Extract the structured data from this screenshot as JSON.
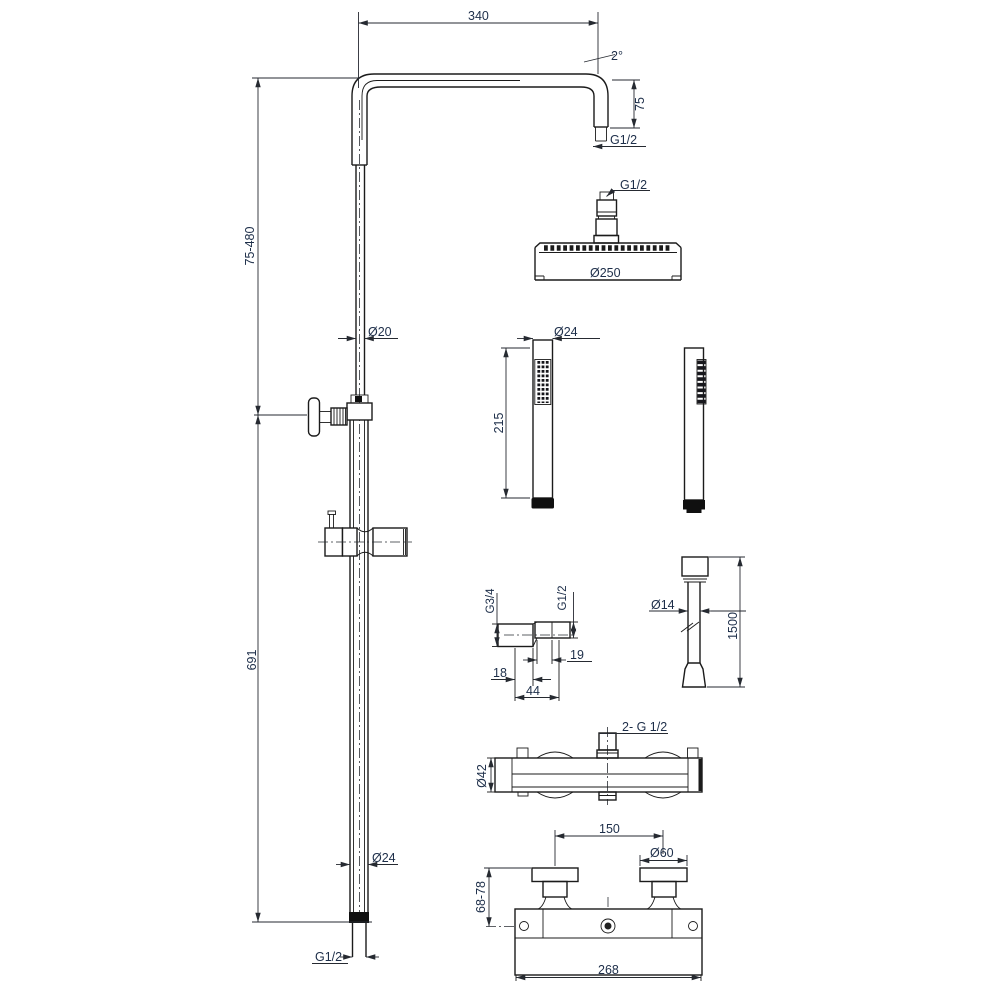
{
  "drawing": {
    "background": "#ffffff",
    "line_color": "#1b1b1b",
    "dim_color": "#1d2e49",
    "labels": {
      "arm_length": "340",
      "arm_angle": "2°",
      "arm_drop": "75",
      "arm_thread": "G1/2",
      "head_thread": "G1/2",
      "head_dia": "Ø250",
      "riser_upper_range": "75-480",
      "riser_upper_dia": "Ø20",
      "riser_lower_length": "691",
      "riser_lower_dia": "Ø24",
      "riser_bottom_thread": "G1/2",
      "handset_dia": "Ø24",
      "handset_length": "215",
      "union_thread_wall": "G3/4",
      "union_thread_out": "G1/2",
      "union_nipple_length": "19",
      "union_body_length": "18",
      "union_total_length": "44",
      "hose_dia": "Ø14",
      "hose_length": "1500",
      "valve_outlets": "2- G 1/2",
      "valve_body_dia": "Ø42",
      "valve_center_distance": "150",
      "valve_handle_dia": "Ø60",
      "valve_offset_range": "68-78",
      "valve_total_width": "268"
    }
  }
}
